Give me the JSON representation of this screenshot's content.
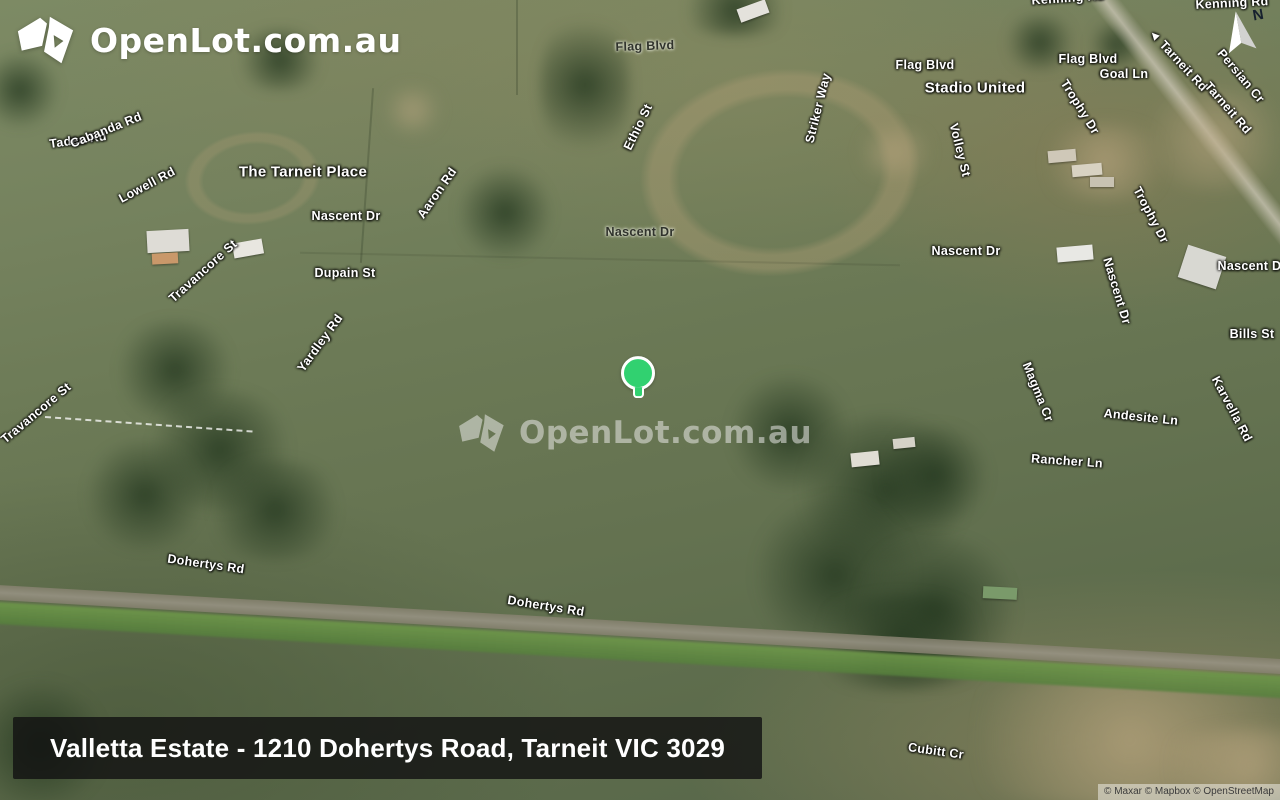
{
  "brand": {
    "logo_text": "OpenLot.com.au",
    "watermark_text": "OpenLot.com.au"
  },
  "caption": {
    "text": "Valletta Estate - 1210 Dohertys Road, Tarneit VIC 3029"
  },
  "attribution": {
    "text": "© Maxar © Mapbox © OpenStreetMap"
  },
  "compass": {
    "label": "N"
  },
  "marker": {
    "x": 638,
    "y": 378,
    "color": "#31d170"
  },
  "colors": {
    "marker_green": "#31d170",
    "caption_background": "rgba(18,18,18,0.82)",
    "label_light": "#ffffff",
    "label_dark": "#30332c"
  },
  "map_labels": [
    {
      "text": "Kenning Rd",
      "x": 1068,
      "y": -2,
      "rot": -4
    },
    {
      "text": "Kenning Rd",
      "x": 1232,
      "y": 3,
      "rot": -3
    },
    {
      "text": "Flag Blvd",
      "x": 645,
      "y": 46,
      "rot": -2,
      "style": "dark"
    },
    {
      "text": "Flag Blvd",
      "x": 925,
      "y": 65,
      "rot": 0
    },
    {
      "text": "Flag Blvd",
      "x": 1088,
      "y": 59,
      "rot": 0
    },
    {
      "text": "Goal Ln",
      "x": 1124,
      "y": 74,
      "rot": 0
    },
    {
      "text": "Stadio United",
      "x": 975,
      "y": 88,
      "rot": 0,
      "style": "place"
    },
    {
      "text": "◄ Tarneit Rd",
      "x": 1178,
      "y": 60,
      "rot": 47
    },
    {
      "text": "Persian Cr",
      "x": 1241,
      "y": 76,
      "rot": 50
    },
    {
      "text": "Tarneit Rd",
      "x": 1228,
      "y": 108,
      "rot": 49
    },
    {
      "text": "Trophy Dr",
      "x": 1080,
      "y": 107,
      "rot": 58
    },
    {
      "text": "Volley St",
      "x": 960,
      "y": 150,
      "rot": 76
    },
    {
      "text": "Striker Way",
      "x": 818,
      "y": 108,
      "rot": -76
    },
    {
      "text": "Ethio St",
      "x": 638,
      "y": 127,
      "rot": -64
    },
    {
      "text": "Tadea Rd",
      "x": 78,
      "y": 140,
      "rot": -8
    },
    {
      "text": "Cabanda Rd",
      "x": 106,
      "y": 130,
      "rot": -22
    },
    {
      "text": "Lowell Rd",
      "x": 147,
      "y": 185,
      "rot": -28
    },
    {
      "text": "The Tarneit Place",
      "x": 303,
      "y": 172,
      "rot": 0,
      "style": "place"
    },
    {
      "text": "Nascent Dr",
      "x": 346,
      "y": 216,
      "rot": 0
    },
    {
      "text": "Aaron Rd",
      "x": 437,
      "y": 193,
      "rot": -55
    },
    {
      "text": "Dupain St",
      "x": 345,
      "y": 273,
      "rot": 0
    },
    {
      "text": "Nascent Dr",
      "x": 640,
      "y": 232,
      "rot": 0,
      "style": "dark"
    },
    {
      "text": "Nascent Dr",
      "x": 966,
      "y": 251,
      "rot": 0
    },
    {
      "text": "Trophy Dr",
      "x": 1151,
      "y": 215,
      "rot": 62
    },
    {
      "text": "Nascent Dr",
      "x": 1117,
      "y": 291,
      "rot": 73
    },
    {
      "text": "Nascent Dr",
      "x": 1252,
      "y": 266,
      "rot": 0
    },
    {
      "text": "Bills St",
      "x": 1252,
      "y": 334,
      "rot": 0
    },
    {
      "text": "Magma Cr",
      "x": 1038,
      "y": 392,
      "rot": 68
    },
    {
      "text": "Andesite Ln",
      "x": 1141,
      "y": 417,
      "rot": 6
    },
    {
      "text": "Karvella Rd",
      "x": 1232,
      "y": 409,
      "rot": 62
    },
    {
      "text": "Rancher Ln",
      "x": 1067,
      "y": 461,
      "rot": 4
    },
    {
      "text": "Travancore St",
      "x": 203,
      "y": 271,
      "rot": -42
    },
    {
      "text": "Travancore St",
      "x": 36,
      "y": 413,
      "rot": -40
    },
    {
      "text": "Yardley Rd",
      "x": 320,
      "y": 343,
      "rot": -54
    },
    {
      "text": "Dohertys Rd",
      "x": 206,
      "y": 564,
      "rot": 8
    },
    {
      "text": "Dohertys Rd",
      "x": 546,
      "y": 606,
      "rot": 9
    },
    {
      "text": "Cubitt Cr",
      "x": 936,
      "y": 751,
      "rot": 8
    }
  ]
}
